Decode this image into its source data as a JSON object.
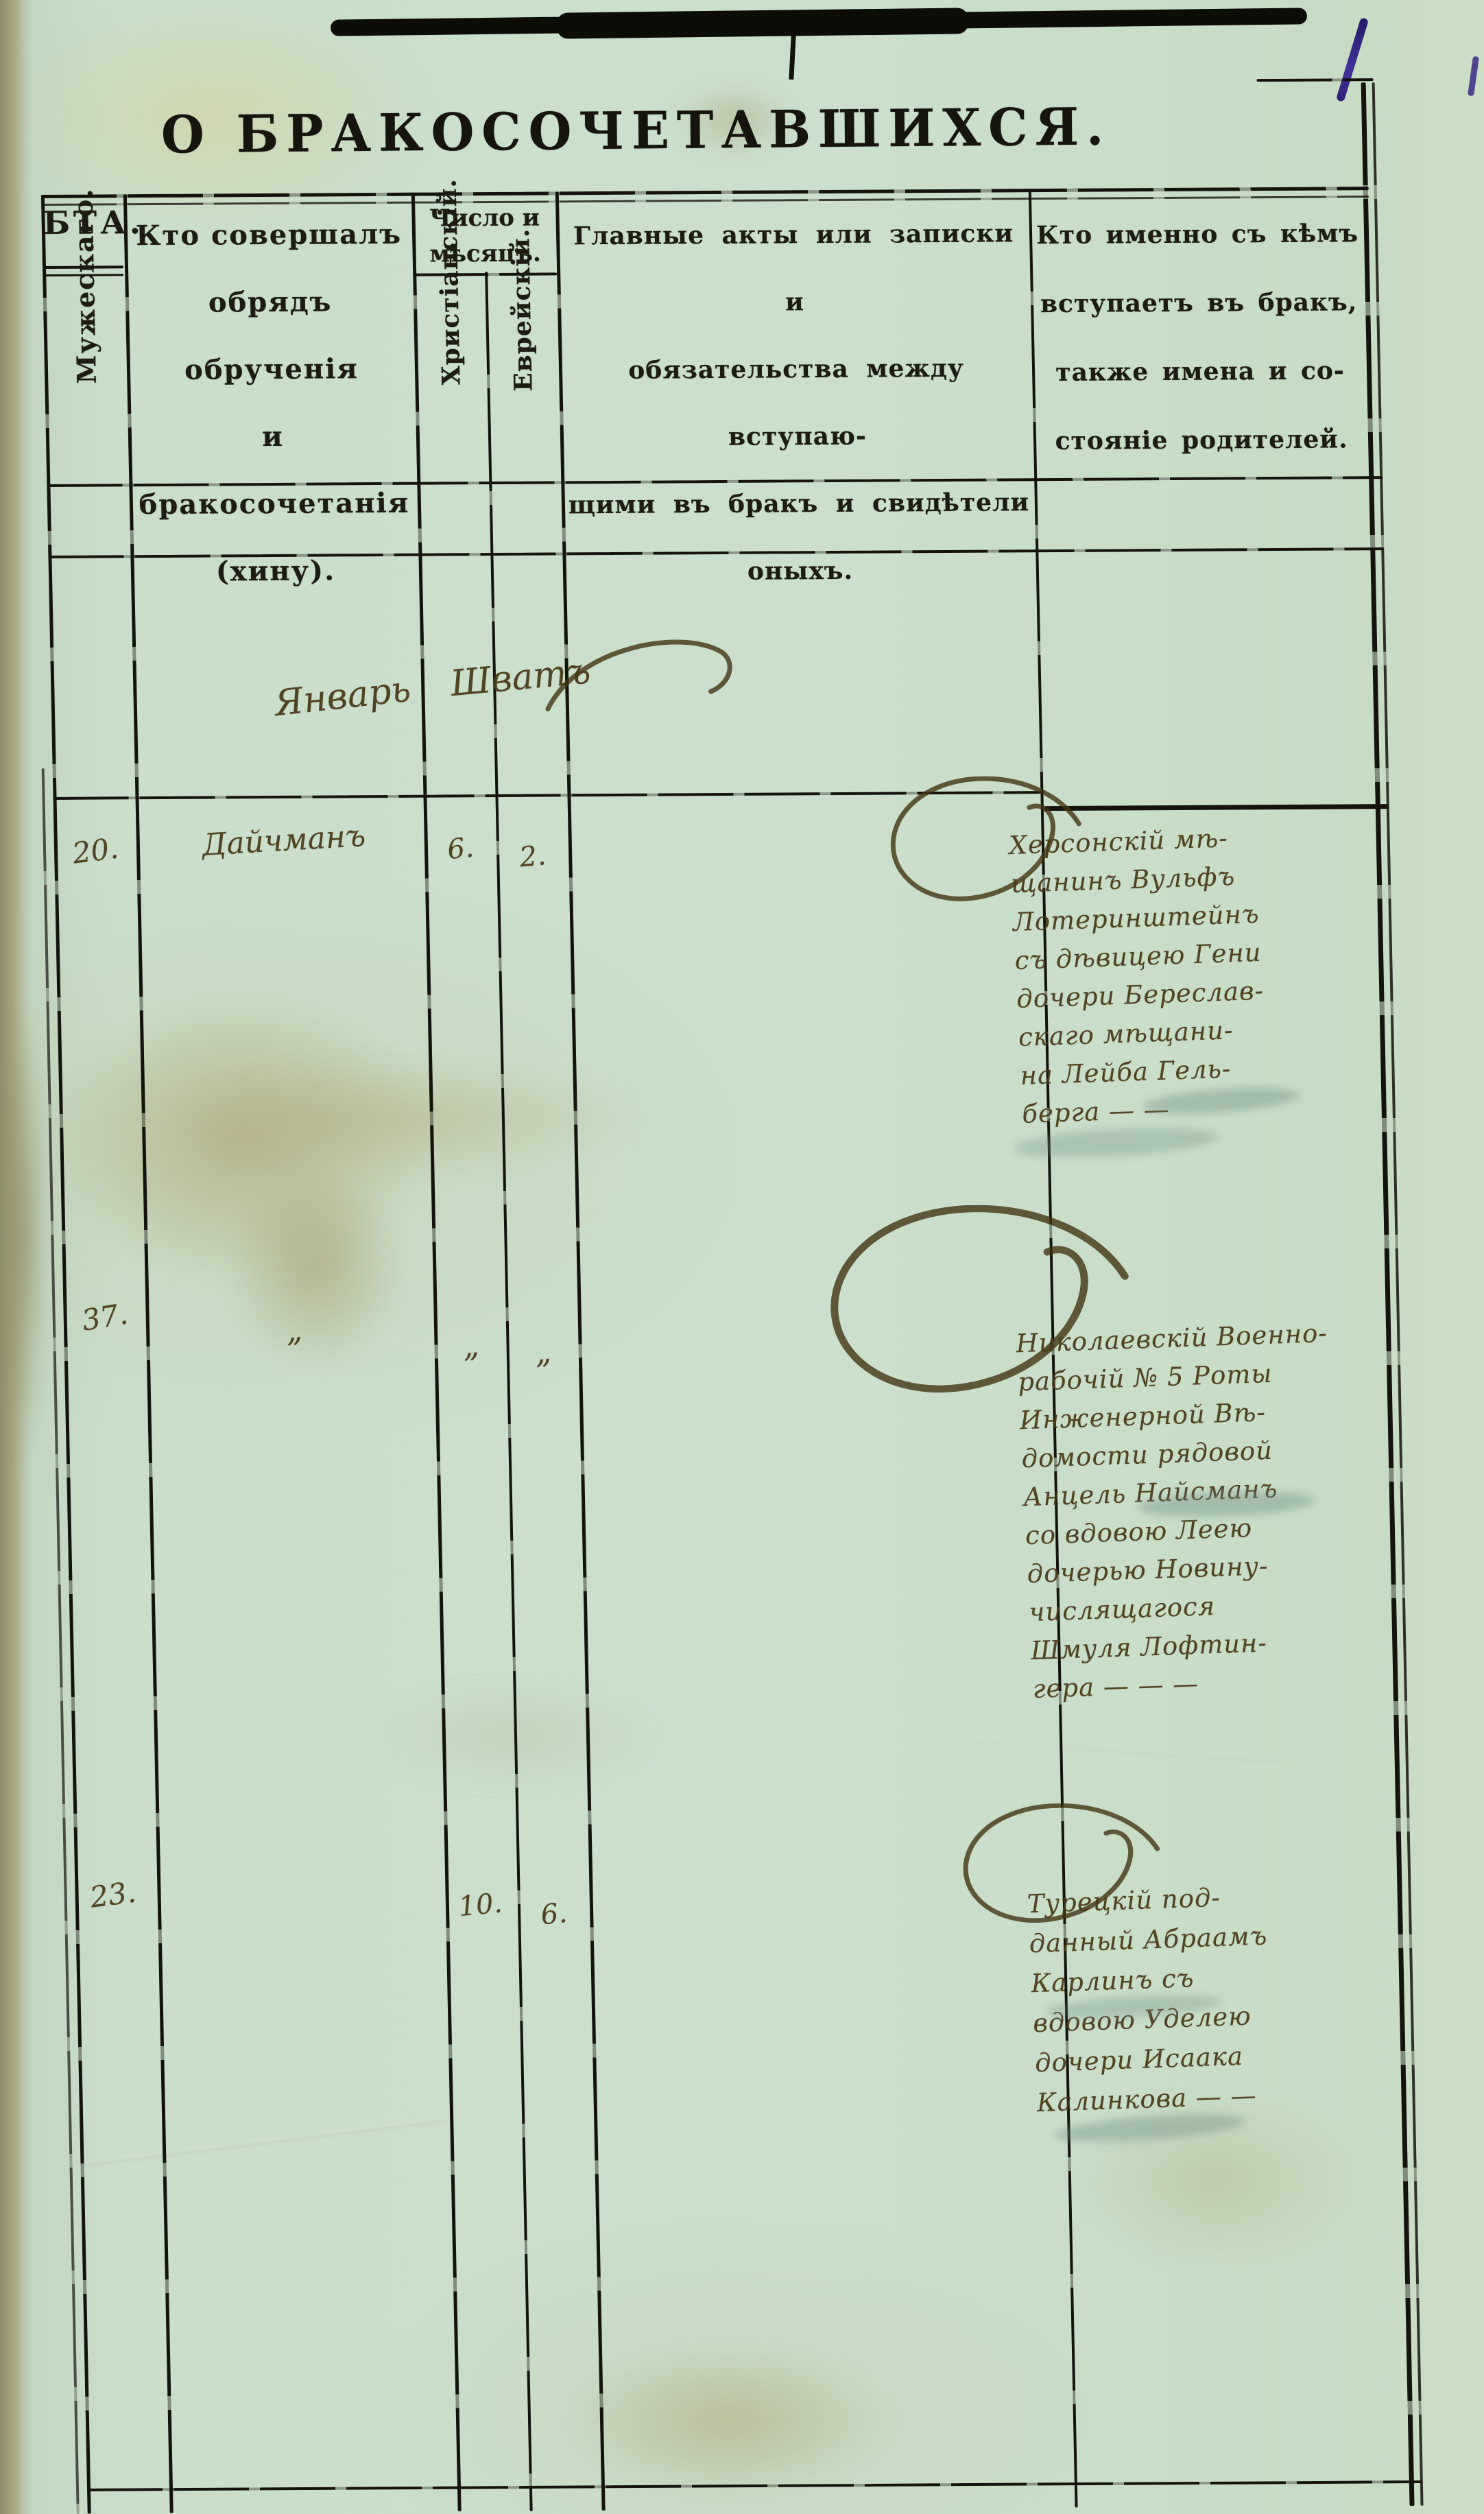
{
  "page": {
    "title": "О БРАКОСОЧЕТАВШИХСЯ."
  },
  "colors": {
    "paper": "#c8ddc9",
    "print_ink": "#15150e",
    "handwriting_ink": "#483818",
    "corner_ink": "#3a2c86"
  },
  "table": {
    "header": {
      "years_label": "БТА.",
      "male_label": "Мужескаго.",
      "officiant_lines": [
        "Кто совершалъ",
        "обрядъ обрученія",
        "и бракосочетанія",
        "(хину)."
      ],
      "date_group_lines": [
        "Число и",
        "мѣсяцъ."
      ],
      "christian_label": "Христіанскій.",
      "jewish_label": "Еврейскій.",
      "acts_lines": [
        "Главные акты или записки и",
        "обязательства между вступаю-",
        "щими въ бракъ и свидѣтели",
        "оныхъ."
      ],
      "who_lines": [
        "Кто именно съ кѣмъ",
        "вступаетъ въ бракъ,",
        "также имена и со-",
        "стояніе родителей."
      ]
    },
    "month_note": {
      "christian": "Январь",
      "jewish": "Шватъ"
    },
    "rows": [
      {
        "number": "20.",
        "officiant": "Дайчманъ",
        "christian_date": "6.",
        "jewish_date": "2.",
        "names_lines": [
          "Херсонскій мѣ-",
          "щанинъ Вульфъ",
          "Лотеринштейнъ",
          "съ дѣвицею Гени",
          "дочери Береслав-",
          "скаго мѣщани-",
          "на Лейба Гель-",
          "берга — —"
        ]
      },
      {
        "number": "37.",
        "officiant": "„",
        "christian_date": "„",
        "jewish_date": "„",
        "names_lines": [
          "Николаевскій Военно-",
          "рабочій № 5 Роты",
          "Инженерной Вѣ-",
          "домости рядовой",
          "Анцель Найсманъ",
          "со вдовою Леею",
          "дочерью Новину-",
          "числящагося",
          "Шмуля Лофтин-",
          "гера — — —"
        ]
      },
      {
        "number": "23.",
        "officiant": "",
        "christian_date": "10.",
        "jewish_date": "6.",
        "names_lines": [
          "Турецкій под-",
          "данный Абраамъ",
          "Карлинъ съ",
          "вдовою Уделею",
          "дочери Исаака",
          "Калинкова — —"
        ]
      }
    ]
  }
}
